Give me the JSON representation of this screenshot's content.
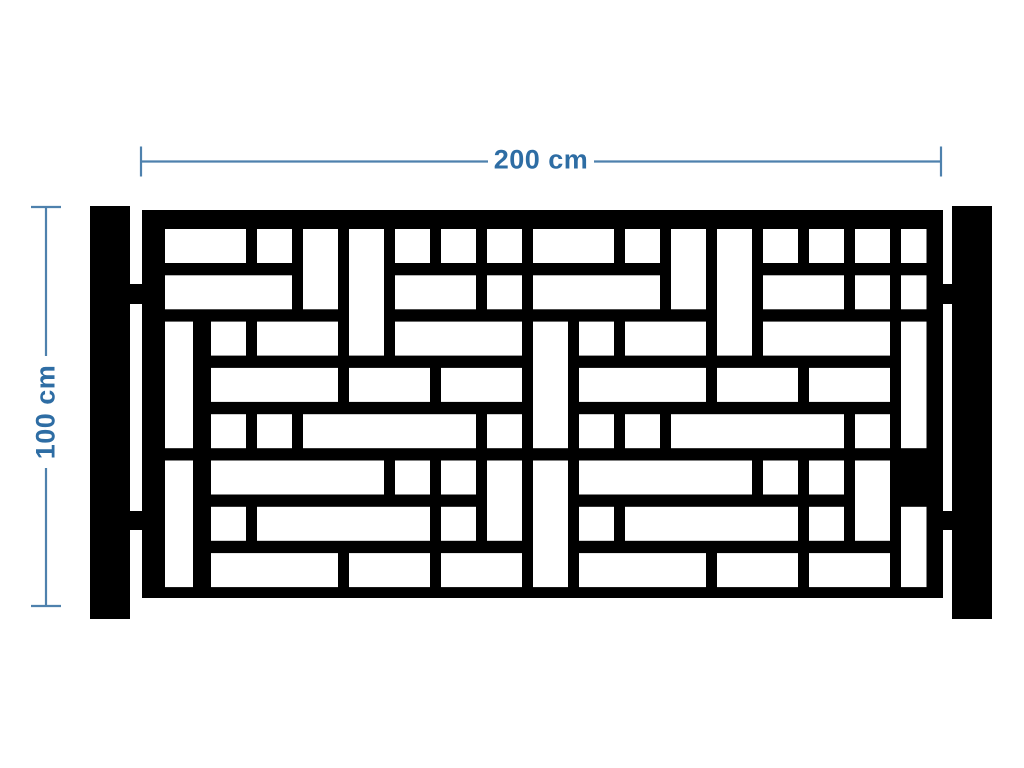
{
  "dimensions": {
    "width_label": "200 cm",
    "height_label": "100 cm"
  },
  "colors": {
    "accent_line": "#4e81ad",
    "accent_text": "#2e6da4",
    "panel": "#000000",
    "background": "#ffffff",
    "cutout": "#ffffff"
  },
  "scene": {
    "panel": {
      "x": 142,
      "y": 210,
      "w": 801,
      "h": 388
    },
    "grid": {
      "x0": 165,
      "y0": 229,
      "col_pitch": 46,
      "row_pitch": 46.3,
      "cell_w": 35,
      "cell_h": 34,
      "clip_right": 926.5,
      "cols": 17,
      "rows": 8
    },
    "cutouts": [
      [
        3,
        1,
        1,
        2
      ],
      [
        11,
        1,
        1,
        2
      ],
      [
        4,
        1,
        1,
        3
      ],
      [
        12,
        1,
        1,
        3
      ],
      [
        0,
        3,
        1,
        3,
        28
      ],
      [
        8,
        3,
        1,
        3
      ],
      [
        16,
        3,
        1,
        3
      ],
      [
        0,
        6,
        1,
        3,
        28
      ],
      [
        8,
        6,
        1,
        3
      ],
      [
        7,
        6,
        1,
        2
      ],
      [
        15,
        6,
        1,
        2
      ],
      [
        16,
        7,
        1,
        2
      ],
      [
        0,
        1,
        2,
        1
      ],
      [
        2,
        1,
        1,
        1
      ],
      [
        5,
        1,
        1,
        1
      ],
      [
        6,
        1,
        1,
        1
      ],
      [
        7,
        1,
        1,
        1
      ],
      [
        8,
        1,
        2,
        1
      ],
      [
        10,
        1,
        1,
        1
      ],
      [
        13,
        1,
        1,
        1
      ],
      [
        14,
        1,
        1,
        1
      ],
      [
        15,
        1,
        1,
        1
      ],
      [
        16,
        1,
        1,
        1
      ],
      [
        0,
        2,
        3,
        1
      ],
      [
        5,
        2,
        2,
        1
      ],
      [
        7,
        2,
        1,
        1
      ],
      [
        8,
        2,
        3,
        1
      ],
      [
        13,
        2,
        2,
        1
      ],
      [
        15,
        2,
        1,
        1
      ],
      [
        16,
        2,
        1,
        1
      ],
      [
        1,
        3,
        1,
        1
      ],
      [
        2,
        3,
        2,
        1
      ],
      [
        5,
        3,
        3,
        1
      ],
      [
        9,
        3,
        1,
        1
      ],
      [
        10,
        3,
        2,
        1
      ],
      [
        13,
        3,
        3,
        1
      ],
      [
        1,
        4,
        3,
        1
      ],
      [
        4,
        4,
        2,
        1
      ],
      [
        6,
        4,
        2,
        1
      ],
      [
        9,
        4,
        3,
        1
      ],
      [
        12,
        4,
        2,
        1
      ],
      [
        14,
        4,
        2,
        1
      ],
      [
        1,
        5,
        1,
        1
      ],
      [
        2,
        5,
        1,
        1
      ],
      [
        3,
        5,
        4,
        1
      ],
      [
        7,
        5,
        1,
        1
      ],
      [
        9,
        5,
        1,
        1
      ],
      [
        10,
        5,
        1,
        1
      ],
      [
        11,
        5,
        4,
        1
      ],
      [
        15,
        5,
        1,
        1
      ],
      [
        1,
        6,
        4,
        1
      ],
      [
        5,
        6,
        1,
        1
      ],
      [
        6,
        6,
        1,
        1
      ],
      [
        9,
        6,
        4,
        1
      ],
      [
        13,
        6,
        1,
        1
      ],
      [
        14,
        6,
        1,
        1
      ],
      [
        1,
        7,
        1,
        1
      ],
      [
        2,
        7,
        4,
        1
      ],
      [
        6,
        7,
        1,
        1
      ],
      [
        9,
        7,
        1,
        1
      ],
      [
        10,
        7,
        4,
        1
      ],
      [
        14,
        7,
        1,
        1
      ],
      [
        1,
        8,
        3,
        1
      ],
      [
        4,
        8,
        2,
        1
      ],
      [
        6,
        8,
        2,
        1
      ],
      [
        9,
        8,
        3,
        1
      ],
      [
        12,
        8,
        2,
        1
      ],
      [
        14,
        8,
        2,
        1
      ]
    ],
    "posts": [
      {
        "name": "left-post",
        "x": 90,
        "y": 206,
        "w": 40,
        "h": 413
      },
      {
        "name": "right-post",
        "x": 952,
        "y": 206,
        "w": 40,
        "h": 413
      }
    ],
    "connectors": [
      {
        "x": 129,
        "y": 284,
        "w": 14,
        "h": 20
      },
      {
        "x": 129,
        "y": 511,
        "w": 14,
        "h": 19
      },
      {
        "x": 941,
        "y": 284,
        "w": 12,
        "h": 20
      },
      {
        "x": 941,
        "y": 511,
        "w": 12,
        "h": 19
      }
    ],
    "dimension_lines": {
      "horizontal": {
        "y": 161.5,
        "x1": 141,
        "x2": 941,
        "gap_start": 488,
        "gap_end": 594,
        "tick_half": 15,
        "stroke_w": 2.2
      },
      "vertical": {
        "x": 46,
        "y1": 207,
        "y2": 606,
        "gap_start": 356,
        "gap_end": 468,
        "tick_half": 15,
        "stroke_w": 2.2
      }
    },
    "labels": {
      "width": {
        "cx": 541,
        "cy": 160
      },
      "height": {
        "cx": 46,
        "cy": 412
      }
    }
  }
}
